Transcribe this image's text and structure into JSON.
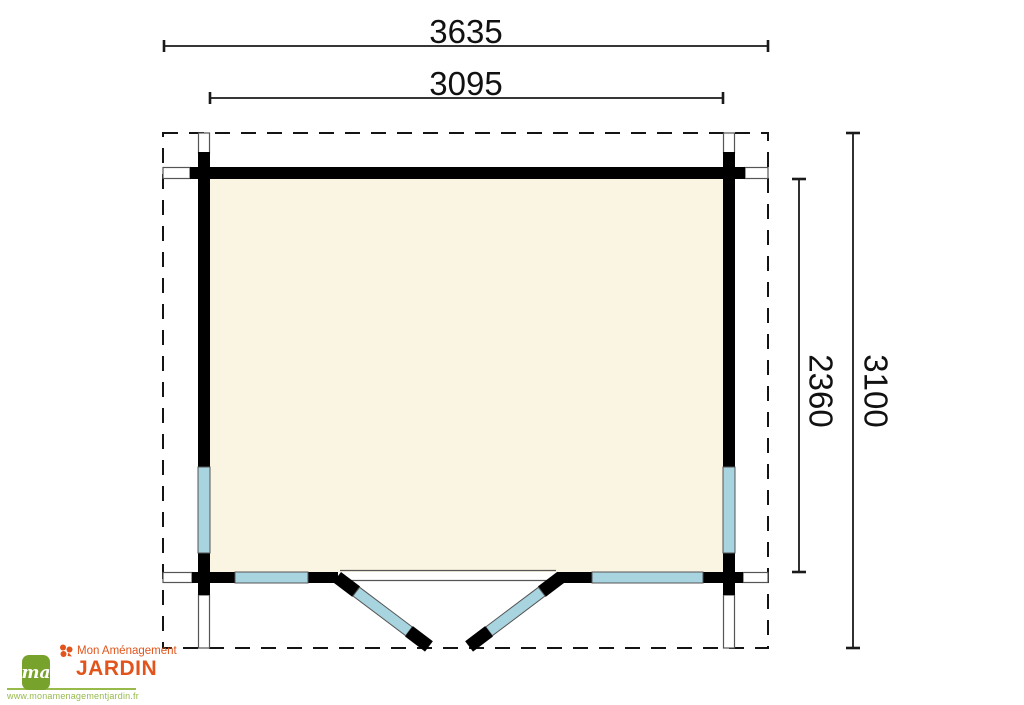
{
  "colors": {
    "wall": "#000000",
    "glazing": "#a7d4df",
    "floor": "#faf4e2",
    "outline": "#555555",
    "dim": "#1a1a1a",
    "logo-orange": "#e2541b",
    "logo-green": "#77a22c",
    "url-green": "#97ba4b"
  },
  "plan": {
    "dim_top_outer": "3635",
    "dim_top_inner": "3095",
    "dim_right_inner": "2360",
    "dim_right_outer": "3100"
  },
  "logo": {
    "monogram": "ma",
    "brand_top": "Mon Aménagement",
    "brand_main": "JARDIN",
    "url": "www.monamenagementjardin.fr"
  }
}
